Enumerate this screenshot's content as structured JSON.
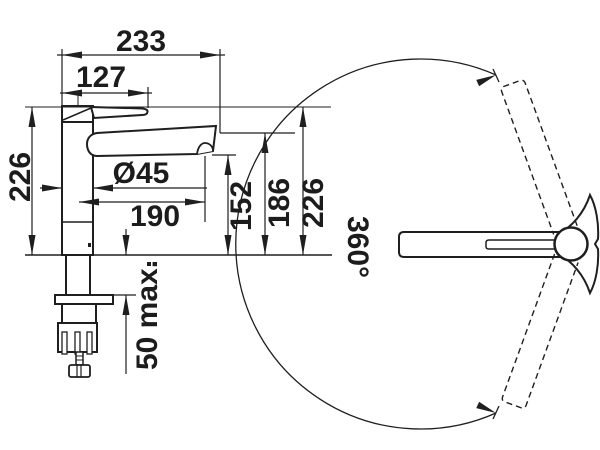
{
  "drawing": {
    "type": "kitchen-faucet-dimension-drawing",
    "dims": {
      "overall_reach": "233",
      "handle_reach": "127",
      "height_left": "226",
      "body_diameter": "Ø45",
      "spout_reach": "190",
      "outlet_height": "152",
      "spout_top_height": "186",
      "height_right": "226",
      "deck_thickness_max": "50 max.",
      "swivel_angle": "360°"
    },
    "colors": {
      "line": "#1f1f1f",
      "background": "#ffffff"
    }
  }
}
